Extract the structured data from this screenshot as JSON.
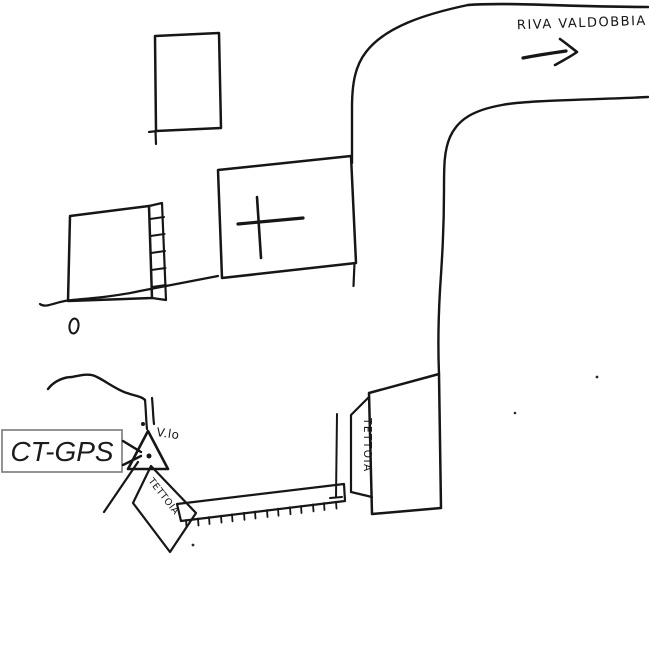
{
  "sketch": {
    "road_destination": "RIVA VALDOBBIA",
    "station_label": "CT-GPS",
    "alley_label": "V.lo",
    "left_canopy_label": "TETTOIA",
    "right_canopy_label": "TETTOIA"
  },
  "colors": {
    "ink": "#161616",
    "paper": "#ffffff",
    "label_border": "#7a7a7a"
  }
}
